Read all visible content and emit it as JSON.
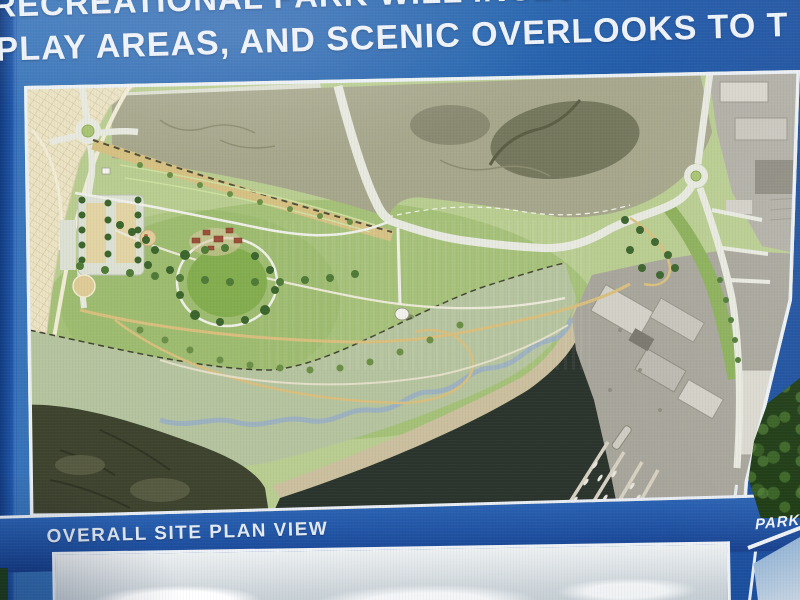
{
  "sign": {
    "headline": {
      "line1": "RECREATIONAL PARK WILL INCLUDE TRAIL",
      "line2": "PLAY AREAS, AND SCENIC OVERLOOKS TO T"
    },
    "panels": {
      "site_plan": {
        "caption": "OVERALL SITE PLAN VIEW"
      },
      "bottom_left": {
        "content": "perspective-rendering-sky-with-clouds"
      },
      "bottom_right": {
        "caption": "PARK",
        "content": "perspective-rendering-sky"
      }
    },
    "colors": {
      "sign_blue": "#2363ae",
      "sign_blue_dark": "#1a4c9b",
      "caption_band_blue": "#1e4f9f",
      "headline_text": "#eef3f9",
      "panel_border_white": "#e9eef4",
      "plan_grass_light": "#b9cd90",
      "plan_grass_mid": "#8fb35c",
      "plan_tree_green": "#3c652c",
      "plan_valley_olive": "#a7a78c",
      "plan_subdivision_tan": "#ebe3c3",
      "plan_levee_beige": "#d6c183",
      "plan_road_white": "#e8eae0",
      "plan_trail_tan": "#d9bf7e",
      "plan_marsh_sage": "#b5c49e",
      "plan_marsh_dark": "#3e432e",
      "plan_water_dark": "#2b342c",
      "plan_beach_tan": "#cbbf9e",
      "plan_creek_blue": "#9db2be",
      "plan_industrial_gray": "#b2b0a6",
      "plan_shipyard_gray": "#a8a69b",
      "plan_roof_red": "#9c4f36",
      "sky_panel_pale": "#ccd4d9",
      "sky_panel_blue": "#7ea6cf",
      "foliage_green": "#1c3a12"
    },
    "site_plan_regions": [
      "residential-subdivision",
      "roundabout-west",
      "parking-area",
      "levee-maintenance-road",
      "river-valley-wetland",
      "park-meadow",
      "visitor-buildings",
      "trail-network",
      "water-tank",
      "salt-marsh",
      "beach-shoreline",
      "bay-water",
      "creek-channel",
      "marina-shipyard",
      "industrial-area-east",
      "roundabout-east"
    ]
  }
}
